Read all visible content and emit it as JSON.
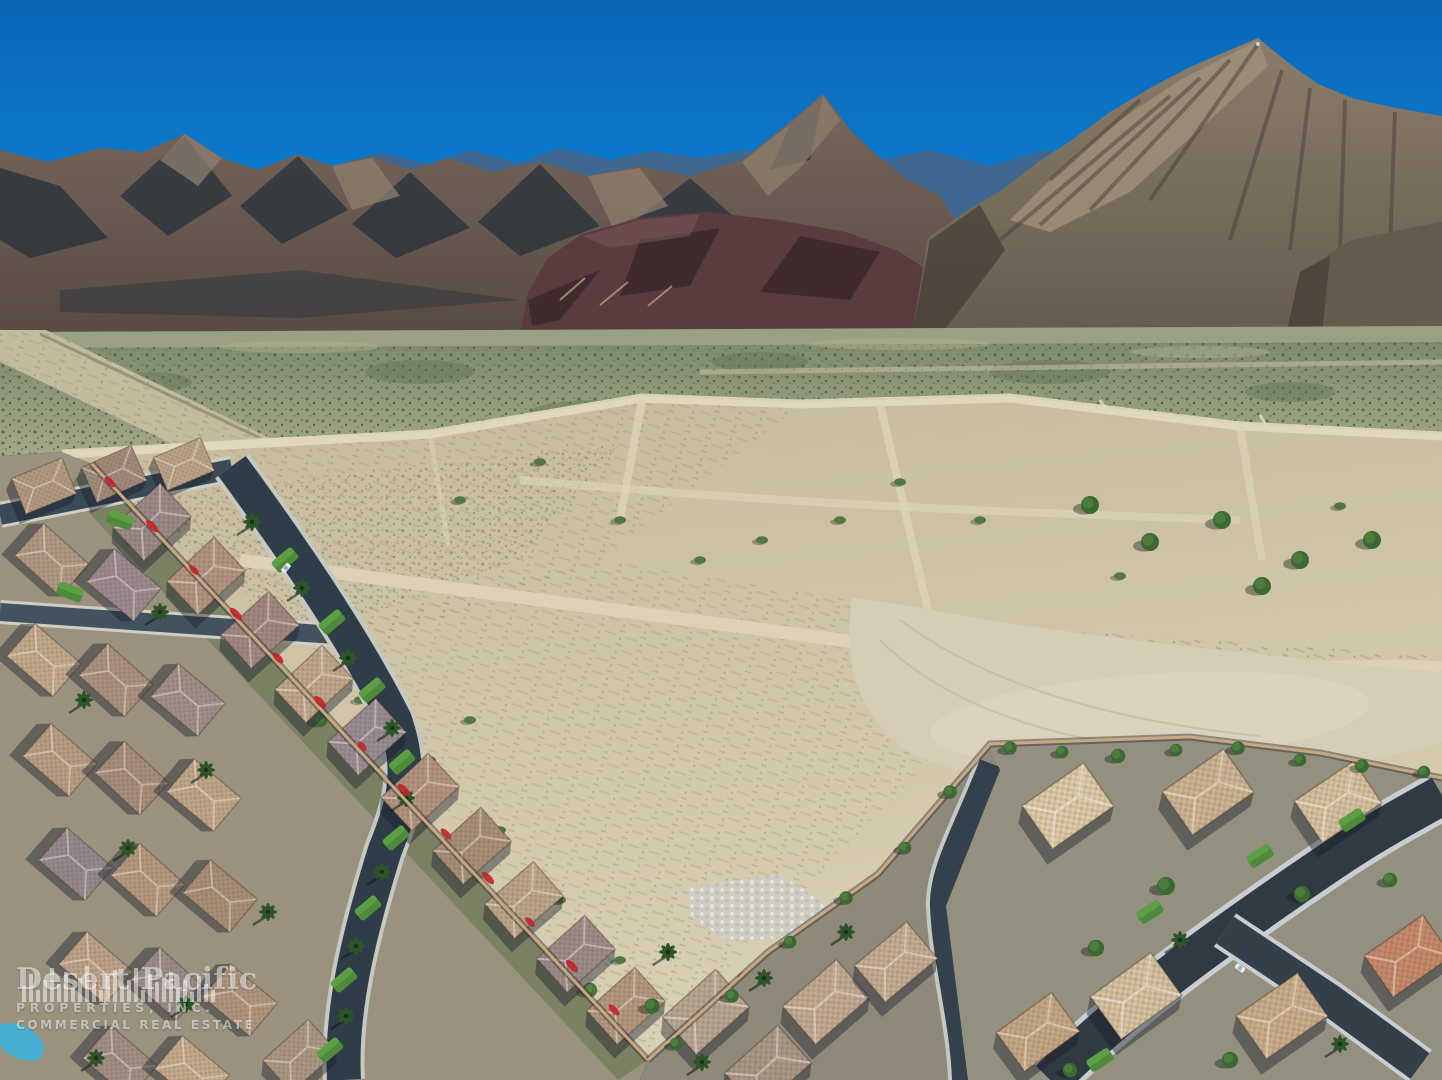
{
  "image": {
    "description": "Aerial drone photograph of a desert community: vacant graded land parcel bordered by tile-roof residential neighborhoods, desert scrub plain and rugged mountains under a clear blue sky",
    "width_px": 1442,
    "height_px": 1080
  },
  "watermark": {
    "icon": "city-skyline-bars-icon",
    "line1": "Desert Pacific",
    "line2": "PROPERTIES, INC.",
    "line3": "COMMERCIAL REAL ESTATE",
    "text_color": "#ffffff",
    "opacity": 0.55
  },
  "palette": {
    "sky_top": "#0a67b8",
    "sky_horizon": "#1897e2",
    "far_ridge_blue": "#3f6890",
    "mountain_lit": "#9c8f7b",
    "mountain_left": "#6e6055",
    "mountain_shadow": "#25303a",
    "maroon_hill": "#5a3c3e",
    "right_mountain": "#8a7d6c",
    "scrub_plain": "#879272",
    "dirt_base": "#c6bb9d",
    "dirt_light": "#d9cfb4",
    "dirt_road": "#e0d7bd",
    "graded_pad": "#d6cdb6",
    "asphalt_street": "#2f3d49",
    "curb_concrete": "#c9cdd0",
    "roof_terracotta": "#a87f6e",
    "roof_tan": "#c2ad90",
    "roof_gray": "#968b8d",
    "roof_cream": "#d8c6a6",
    "lawn_green": "#4e8a39",
    "tree_green": "#3c6833",
    "palm_green": "#2e5429",
    "bougainvillea_red": "#c1232b",
    "pool_blue": "#49aed0",
    "rubble_gray": "#cfcdc2",
    "wall_tan": "#caa87e"
  }
}
